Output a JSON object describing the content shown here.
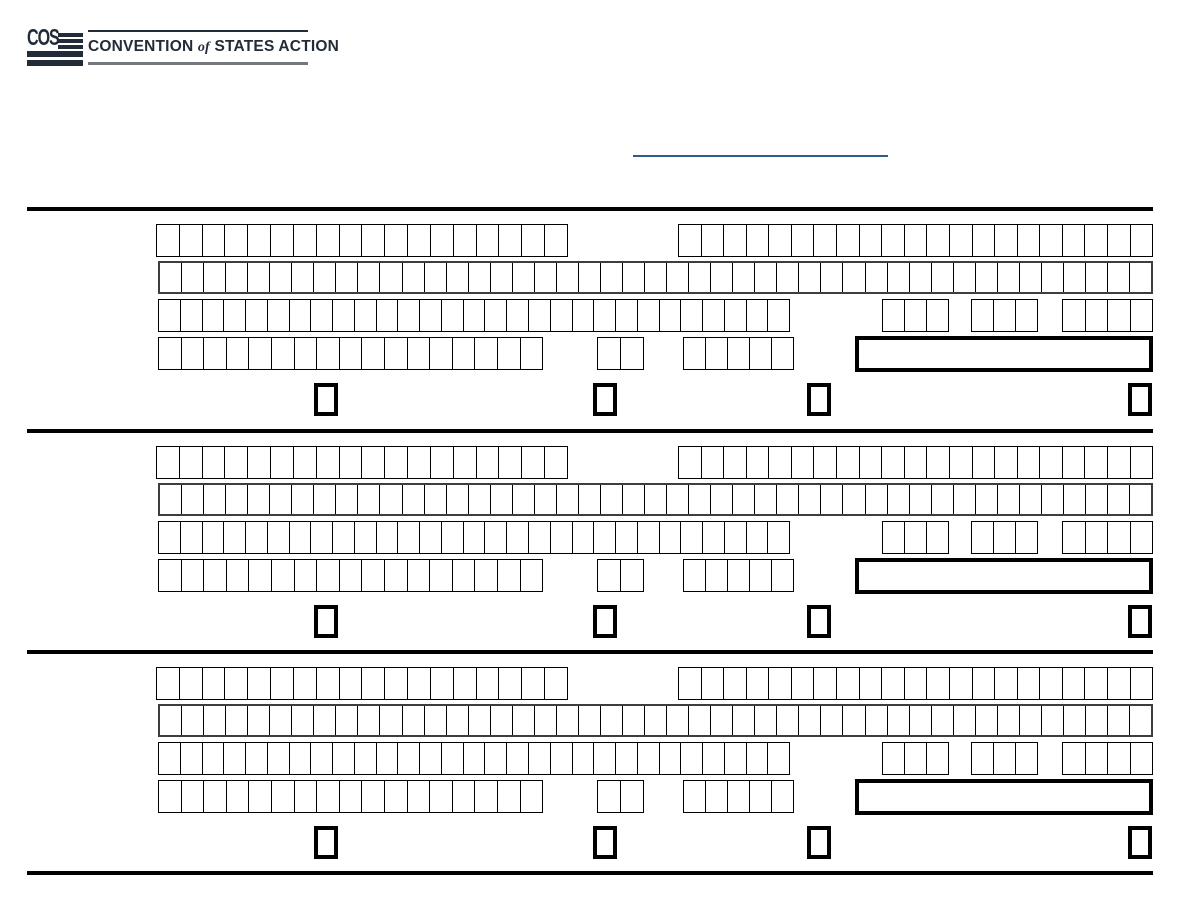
{
  "logo": {
    "acronym": "COS",
    "wordmark_pre": "CONVENTION",
    "wordmark_of": "of",
    "wordmark_post": "STATES ACTION"
  },
  "colors": {
    "brand_navy": "#222c38",
    "logo_rule_gray": "#74777b",
    "header_underline_blue": "#2b5c8e",
    "form_line_black": "#000000"
  },
  "form": {
    "section_count": 3,
    "sections": [
      {
        "index": 1
      },
      {
        "index": 2
      },
      {
        "index": 3
      }
    ],
    "grid_cells": {
      "row1_left": 18,
      "row1_right": 21,
      "row2_full": 45,
      "row3_main": 29,
      "phone_part1": 3,
      "phone_part2": 3,
      "phone_part3": 4,
      "row4_main": 17,
      "row4_two": 2,
      "row4_five": 5
    },
    "signature_boxes_per_section": 1,
    "checkboxes_per_section": 4
  }
}
